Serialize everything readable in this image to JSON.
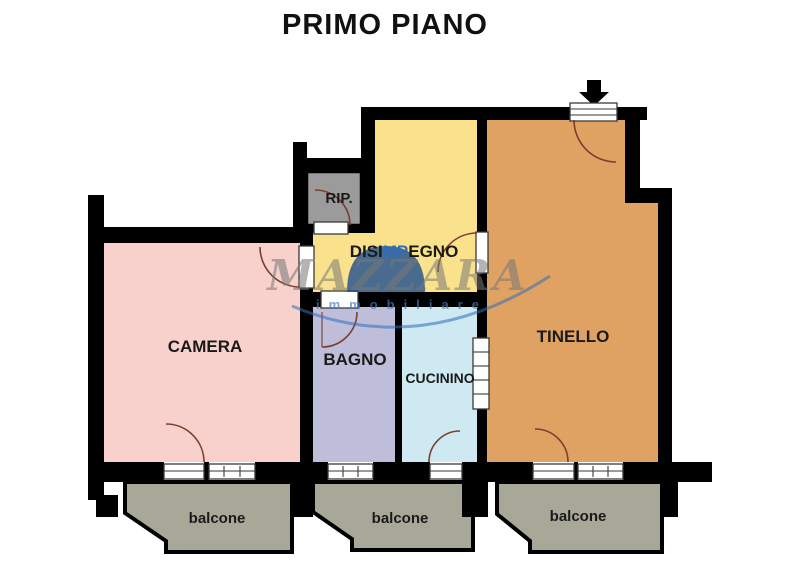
{
  "title": "PRIMO PIANO",
  "colors": {
    "background": "#ffffff",
    "wall": "#000000",
    "balcony": "#a8a899",
    "door_arc": "#7a4030",
    "symbol_line": "#3a3a3a"
  },
  "rooms": {
    "camera": {
      "label": "CAMERA",
      "color": "#f8d1cc"
    },
    "bagno": {
      "label": "BAGNO",
      "color": "#bfbeda"
    },
    "cucinino": {
      "label": "CUCININO",
      "color": "#cfe9f2"
    },
    "tinello": {
      "label": "TINELLO",
      "color": "#e0a263"
    },
    "disimpegno": {
      "label_pre": "DISI",
      "label_mid": "MP",
      "label_post": "EGNO",
      "color": "#fae18c",
      "mid_color": "#2e6dbd"
    },
    "rip": {
      "label": "RIP.",
      "color": "#9b9b9b"
    }
  },
  "balconies": [
    {
      "label": "balcone"
    },
    {
      "label": "balcone"
    },
    {
      "label": "balcone"
    }
  ],
  "watermark": {
    "name": "MAZZARA",
    "subtitle": "immobiliare",
    "name_color": "#787878",
    "subtitle_color": "#4a7ab5",
    "blob_color": "#1d4f8f",
    "swoosh_color": "#2f6db8"
  }
}
